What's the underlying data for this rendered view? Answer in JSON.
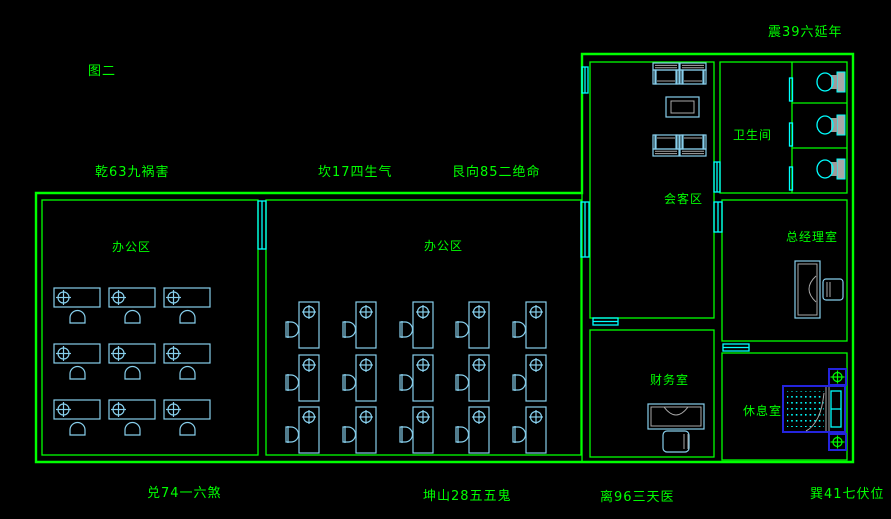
{
  "annotations": {
    "figure": "图二"
  },
  "fengshui": {
    "qian": "乾63九祸害",
    "kan": "坎17四生气",
    "gen": "艮向85二绝命",
    "zhen": "震39六延年",
    "dui": "兑74一六煞",
    "kun": "坤山28五五鬼",
    "li": "离96三天医",
    "xun": "巽41七伏位"
  },
  "rooms": {
    "office_left": "办公区",
    "office_center": "办公区",
    "reception": "会客区",
    "bathroom": "卫生间",
    "general_manager": "总经理室",
    "finance": "财务室",
    "rest": "休息室"
  },
  "colors": {
    "background": "#000000",
    "wall": "#00ff00",
    "text": "#00ff00",
    "furniture": "#87CEEB",
    "window": "#00ffff",
    "bed": "#2424dd",
    "detail_gray": "#a9a9a9"
  }
}
